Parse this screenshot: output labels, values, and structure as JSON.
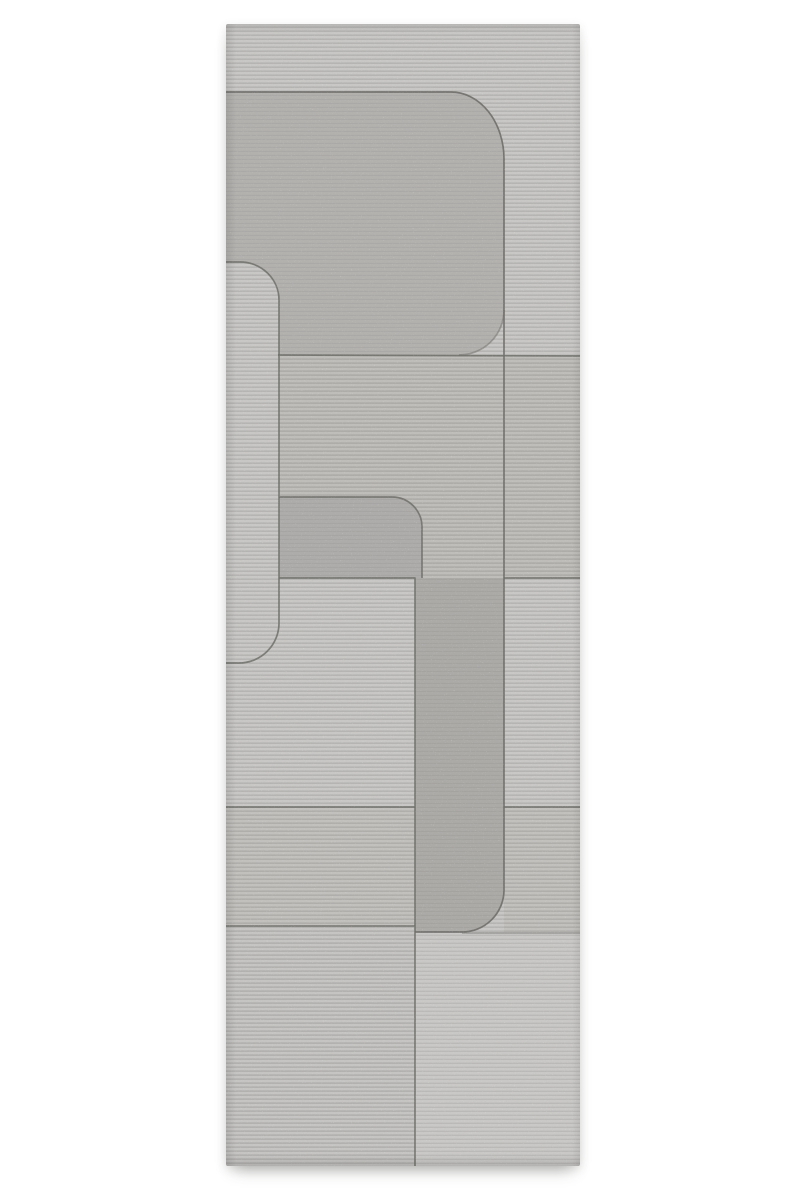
{
  "scene": {
    "type": "product-photo",
    "subject": "grey hand-carved wool runner rug with abstract rounded-rectangle relief pattern",
    "background_color": "#ffffff"
  },
  "rug": {
    "x": 226,
    "y": 24,
    "width": 354,
    "height": 1142,
    "palette": {
      "groove": "#6f6e6a",
      "patterns": [
        {
          "id": "pLight",
          "bg": "#c8c7c5",
          "stripe": "#b5b4b2",
          "stripeH": 1.6,
          "period": 4
        },
        {
          "id": "pMed",
          "bg": "#bfbdb9",
          "stripe": "#aeaca8",
          "stripeH": 1.7,
          "period": 4
        },
        {
          "id": "pMedLight",
          "bg": "#c2c0bd",
          "stripe": "#b0aeab",
          "stripeH": 1.6,
          "period": 4
        },
        {
          "id": "pBL",
          "bg": "#c5c4c2",
          "stripe": "#b2b1af",
          "stripeH": 1.7,
          "period": 4
        },
        {
          "id": "pBR",
          "bg": "#c9c8c6",
          "stripe": "#bab9b7",
          "stripeH": 1.4,
          "period": 4
        },
        {
          "id": "pShapeB",
          "bg": "#b3b1ae",
          "stripe": "#aba9a7",
          "stripeH": 1.2,
          "period": 4
        },
        {
          "id": "pShapeD",
          "bg": "#aeacaa",
          "stripe": "#a7a5a3",
          "stripeH": 1.1,
          "period": 4
        },
        {
          "id": "pShapeE",
          "bg": "#acaaa7",
          "stripe": "#a4a3a0",
          "stripeH": 1.1,
          "period": 4
        }
      ]
    },
    "regions": [
      {
        "name": "base-field",
        "type": "rect",
        "x": 0,
        "y": 0,
        "w": 354,
        "h": 1142,
        "fill": "pLight"
      },
      {
        "name": "top-rounded-block",
        "type": "path",
        "d": "M 0 68 L 225 68 A 53 67 0 0 1 278 135 L 278 286 A 45 45 0 0 1 233 331 L 0 331 Z",
        "fill": "pShapeB"
      },
      {
        "name": "mid-left-field",
        "type": "rect",
        "x": 53,
        "y": 331,
        "w": 225,
        "h": 223,
        "fill": "pMed"
      },
      {
        "name": "right-band-mid",
        "type": "rect",
        "x": 278,
        "y": 333,
        "w": 76,
        "h": 221,
        "fill": "pMed"
      },
      {
        "name": "left-band",
        "type": "rect",
        "x": 0,
        "y": 783,
        "w": 189,
        "h": 119,
        "fill": "pMedLight"
      },
      {
        "name": "right-band-low",
        "type": "rect",
        "x": 278,
        "y": 783,
        "w": 76,
        "h": 126,
        "fill": "pMedLight"
      },
      {
        "name": "bottom-left-field",
        "type": "rect",
        "x": 0,
        "y": 902,
        "w": 189,
        "h": 240,
        "fill": "pBL"
      },
      {
        "name": "bottom-right-field",
        "type": "rect",
        "x": 189,
        "y": 908,
        "w": 165,
        "h": 234,
        "fill": "pBR"
      },
      {
        "name": "small-rounded-block",
        "type": "path",
        "d": "M 53 473 L 166 473 A 30 30 0 0 1 196 503 L 196 554 L 53 554 Z",
        "fill": "pShapeD"
      },
      {
        "name": "center-dark-column",
        "type": "path",
        "d": "M 189 554 L 278 554 L 278 866 A 42 42 0 0 1 236 908 L 189 908 Z",
        "fill": "pShapeE"
      },
      {
        "name": "left-rounded-strip",
        "type": "path",
        "d": "M 0 238 L 14 238 A 39 38 0 0 1 53 276 L 53 599 A 40 40 0 0 1 13 639 L 0 639 Z",
        "fill": "pLight"
      }
    ],
    "grooves": [
      {
        "d": "M 0 68 L 225 68 A 53 67 0 0 1 278 135 L 278 866 A 42 42 0 0 1 236 908 L 189 908",
        "opacity": 0.9
      },
      {
        "d": "M 52 331 L 354 332",
        "opacity": 0.85
      },
      {
        "d": "M 278 286 A 45 45 0 0 1 233 331",
        "opacity": 0.5
      },
      {
        "d": "M 0 238 L 14 238 A 39 38 0 0 1 53 276 L 53 599 A 40 40 0 0 1 13 639 L 0 639",
        "opacity": 0.85
      },
      {
        "d": "M 53 473 L 166 473 A 30 30 0 0 1 196 503 L 196 554",
        "opacity": 0.85
      },
      {
        "d": "M 53 554 L 189 554 L 189 1142",
        "opacity": 0.85
      },
      {
        "d": "M 278 554 L 354 554",
        "opacity": 0.85
      },
      {
        "d": "M 0 783 L 189 783",
        "opacity": 0.85
      },
      {
        "d": "M 278 783 L 354 783",
        "opacity": 0.85
      },
      {
        "d": "M 0 902 L 189 902",
        "opacity": 0.8
      },
      {
        "d": "M 236 909 L 354 909",
        "opacity": 0.45
      }
    ],
    "groove_width": 1.7,
    "edge_shading": [
      {
        "side": "top",
        "size": 9,
        "alpha": 0.1
      },
      {
        "side": "left",
        "size": 10,
        "alpha": 0.11
      },
      {
        "side": "right",
        "size": 8,
        "alpha": 0.08
      },
      {
        "side": "bottom",
        "size": 11,
        "alpha": 0.13
      }
    ]
  }
}
